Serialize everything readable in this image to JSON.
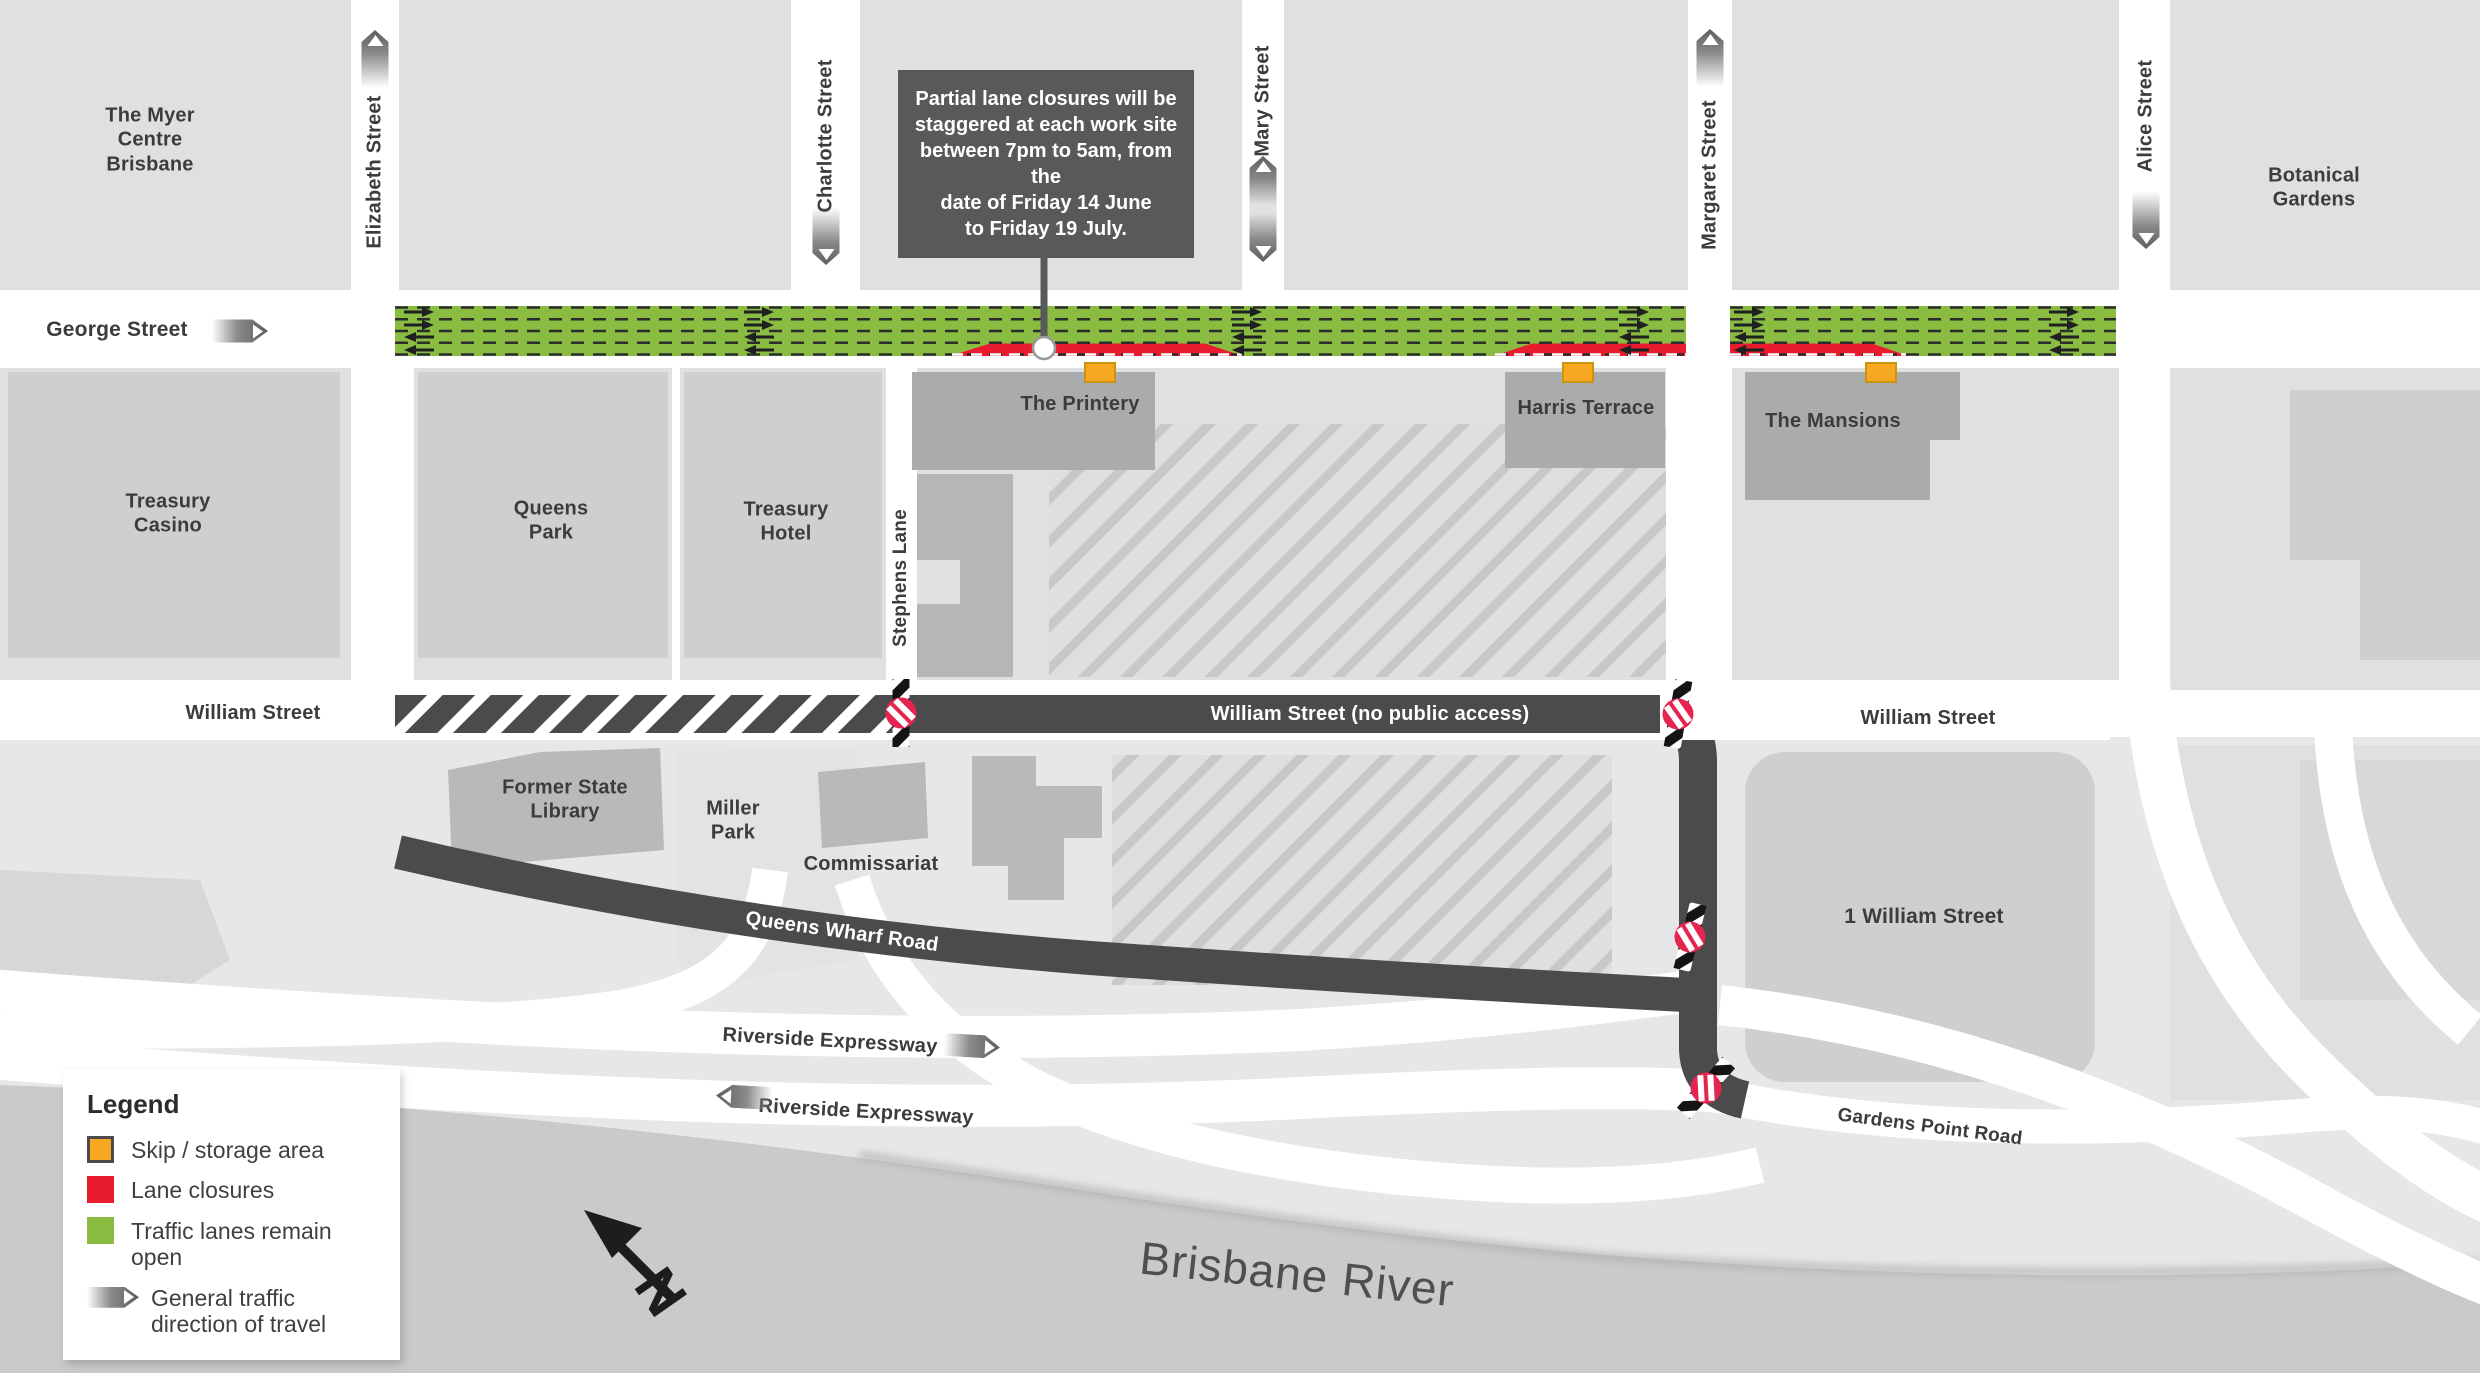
{
  "colors": {
    "traffic_open_green": "#8ABC42",
    "lane_closure_red": "#E81C2E",
    "skip_storage_orange": "#F7A823",
    "road_dark": "#4B4B4D",
    "building_gray": "#A9ABAD",
    "block_gray": "#DFE0E1",
    "river_gray": "#C9CACB",
    "no_entry_red": "#E5254F",
    "callout_gray": "#58595B"
  },
  "callout": {
    "text": "Partial lane closures will be\nstaggered at each work site\nbetween 7pm to 5am, from the\ndate of Friday 14 June\nto Friday 19 July."
  },
  "legend": {
    "title": "Legend",
    "items": [
      {
        "label": "Skip / storage area"
      },
      {
        "label": "Lane closures"
      },
      {
        "label": "Traffic lanes remain open"
      },
      {
        "label": "General traffic\ndirection of travel"
      }
    ]
  },
  "streets": {
    "george": "George Street",
    "elizabeth": "Elizabeth Street",
    "charlotte": "Charlotte Street",
    "mary": "Mary Street",
    "margaret": "Margaret Street",
    "alice": "Alice Street",
    "stephens_lane": "Stephens Lane",
    "william_west": "William Street",
    "william_closed": "William Street (no public access)",
    "william_east": "William Street",
    "queens_wharf": "Queens Wharf Road",
    "riverside_outbound": "Riverside Expressway",
    "riverside_inbound": "Riverside Expressway",
    "gardens_point": "Gardens Point Road"
  },
  "places": {
    "myer_centre": "The Myer\nCentre\nBrisbane",
    "botanical_gardens": "Botanical\nGardens",
    "treasury_casino": "Treasury\nCasino",
    "queens_park": "Queens\nPark",
    "treasury_hotel": "Treasury\nHotel",
    "printery": "The Printery",
    "harris_terrace": "Harris Terrace",
    "mansions": "The Mansions",
    "former_state_library": "Former State\nLibrary",
    "miller_park": "Miller\nPark",
    "commissariat": "Commissariat",
    "one_william": "1 William Street",
    "brisbane_river": "Brisbane River"
  },
  "compass": {
    "north_label": "N"
  }
}
